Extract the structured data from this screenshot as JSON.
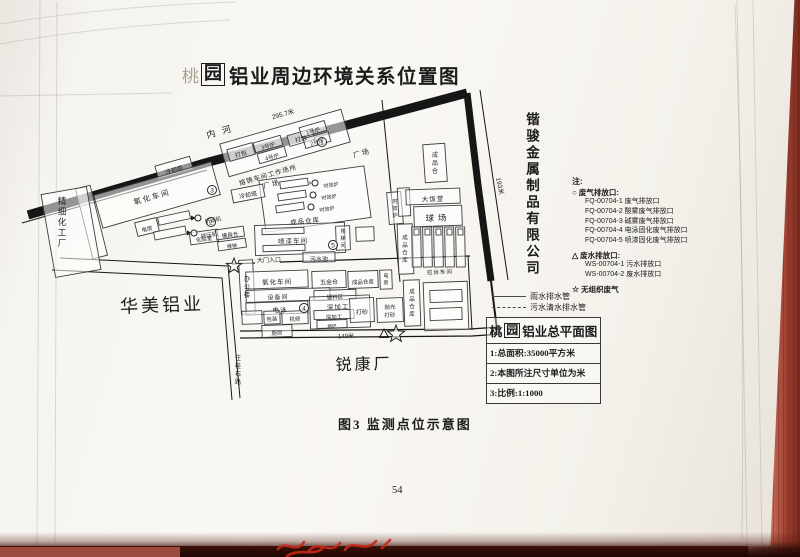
{
  "page": {
    "title": {
      "prefix": "桃",
      "boxed": "园",
      "rest": "铝业周边环境关系位置图"
    },
    "caption": "图3  监测点位示意图",
    "page_number": "54"
  },
  "neighbors": {
    "right_company": "锴骏金属制品有限公司",
    "left_company": "华美铝业",
    "left_factory": "精细化工厂",
    "bottom_factory": "锐康厂",
    "road_label": "往桂石路"
  },
  "legend": {
    "note_label": "注:",
    "gas": {
      "symbol": "○",
      "title": "废气排放口:",
      "items": [
        "FQ-00704-1 废气排放口",
        "FQ-00704-2 酸雾废气排放口",
        "FQ-00704-3 碱雾废气排放口",
        "FQ-00704-4 电泳固化废气排放口",
        "FQ-00704-5 喷漆固化废气排放口"
      ]
    },
    "water": {
      "symbol": "△",
      "title": "废水排放口:",
      "items": [
        "WS-00704-1 污水排放口",
        "WS-00704-2 废水排放口"
      ]
    },
    "fugitive": {
      "symbol": "☆",
      "title": "无组织废气"
    }
  },
  "pipes": [
    {
      "style": "solid",
      "label": "雨水排水管"
    },
    {
      "style": "dashed",
      "label": "污水清水排水管"
    }
  ],
  "info_box": {
    "title_prefix": "桃",
    "title_boxed": "园",
    "title_rest": "铝业总平面图",
    "rows": [
      "1:总面积:35000平方米",
      "2:本图所注尺寸单位为米",
      "3:比例:1:1000"
    ]
  },
  "map": {
    "river_label": "内河",
    "boxes": [
      {
        "x": 156,
        "y": 161,
        "w": 36,
        "h": 13,
        "r": -16
      },
      {
        "x": 222,
        "y": 126,
        "w": 126,
        "h": 34,
        "r": -16
      },
      {
        "x": 228,
        "y": 146,
        "w": 26,
        "h": 12,
        "r": -16
      },
      {
        "x": 254,
        "y": 139,
        "w": 28,
        "h": 10,
        "r": -16
      },
      {
        "x": 258,
        "y": 150,
        "w": 28,
        "h": 10,
        "r": -16
      },
      {
        "x": 288,
        "y": 132,
        "w": 26,
        "h": 11,
        "r": -16
      },
      {
        "x": 300,
        "y": 124,
        "w": 26,
        "h": 10,
        "r": -16
      },
      {
        "x": 304,
        "y": 135,
        "w": 26,
        "h": 10,
        "r": -16
      },
      {
        "x": 96,
        "y": 178,
        "w": 122,
        "h": 34,
        "r": -16
      },
      {
        "x": 84,
        "y": 186,
        "w": 15,
        "h": 72,
        "r": -14
      },
      {
        "x": 48,
        "y": 190,
        "w": 46,
        "h": 84,
        "r": -10
      },
      {
        "x": 136,
        "y": 220,
        "w": 22,
        "h": 14,
        "r": -14
      },
      {
        "x": 158,
        "y": 214,
        "w": 32,
        "h": 8,
        "r": -12
      },
      {
        "x": 154,
        "y": 229,
        "w": 32,
        "h": 8,
        "r": -11
      },
      {
        "x": 190,
        "y": 231,
        "w": 28,
        "h": 12,
        "r": -8
      },
      {
        "x": 216,
        "y": 228,
        "w": 28,
        "h": 10,
        "r": -8
      },
      {
        "x": 218,
        "y": 240,
        "w": 28,
        "h": 9,
        "r": -8
      },
      {
        "x": 240,
        "y": 260,
        "w": 14,
        "h": 54,
        "r": -3
      },
      {
        "x": 262,
        "y": 173,
        "w": 106,
        "h": 52,
        "r": -8
      },
      {
        "x": 280,
        "y": 180,
        "w": 28,
        "h": 7,
        "r": -8
      },
      {
        "x": 278,
        "y": 192,
        "w": 28,
        "h": 7,
        "r": -8
      },
      {
        "x": 276,
        "y": 204,
        "w": 28,
        "h": 7,
        "r": -8
      },
      {
        "x": 388,
        "y": 192,
        "w": 14,
        "h": 32,
        "r": -5
      },
      {
        "x": 232,
        "y": 187,
        "w": 32,
        "h": 13,
        "r": -11
      },
      {
        "x": 398,
        "y": 224,
        "w": 15,
        "h": 50,
        "r": -2
      },
      {
        "x": 424,
        "y": 144,
        "w": 22,
        "h": 38,
        "r": -4
      },
      {
        "x": 398,
        "y": 188,
        "w": 12,
        "h": 28,
        "r": -3
      },
      {
        "x": 406,
        "y": 189,
        "w": 54,
        "h": 15,
        "r": -2
      },
      {
        "x": 414,
        "y": 206,
        "w": 48,
        "h": 20,
        "r": -2
      },
      {
        "x": 255,
        "y": 224,
        "w": 90,
        "h": 30,
        "r": -2
      },
      {
        "x": 262,
        "y": 228,
        "w": 42,
        "h": 6,
        "r": -2
      },
      {
        "x": 263,
        "y": 245,
        "w": 42,
        "h": 6,
        "r": -2
      },
      {
        "x": 336,
        "y": 226,
        "w": 14,
        "h": 24,
        "r": -2
      },
      {
        "x": 356,
        "y": 227,
        "w": 18,
        "h": 14,
        "r": -2
      },
      {
        "x": 303,
        "y": 252,
        "w": 32,
        "h": 10,
        "r": -1
      },
      {
        "x": 246,
        "y": 271,
        "w": 62,
        "h": 17,
        "r": -2
      },
      {
        "x": 312,
        "y": 271,
        "w": 34,
        "h": 17,
        "r": -2
      },
      {
        "x": 348,
        "y": 271,
        "w": 30,
        "h": 17,
        "r": -2
      },
      {
        "x": 380,
        "y": 270,
        "w": 12,
        "h": 19,
        "r": -2
      },
      {
        "x": 246,
        "y": 289,
        "w": 84,
        "h": 12,
        "r": -2
      },
      {
        "x": 314,
        "y": 290,
        "w": 42,
        "h": 10,
        "r": -2
      },
      {
        "x": 246,
        "y": 302,
        "w": 62,
        "h": 12,
        "r": -2
      },
      {
        "x": 242,
        "y": 311,
        "w": 20,
        "h": 13,
        "r": -2
      },
      {
        "x": 264,
        "y": 311,
        "w": 16,
        "h": 13,
        "r": -2
      },
      {
        "x": 282,
        "y": 311,
        "w": 26,
        "h": 13,
        "r": -2
      },
      {
        "x": 262,
        "y": 325,
        "w": 30,
        "h": 12,
        "r": -2
      },
      {
        "x": 310,
        "y": 296,
        "w": 60,
        "h": 32,
        "r": -2
      },
      {
        "x": 314,
        "y": 310,
        "w": 40,
        "h": 9,
        "r": -2
      },
      {
        "x": 317,
        "y": 320,
        "w": 30,
        "h": 8,
        "r": -2
      },
      {
        "x": 350,
        "y": 298,
        "w": 24,
        "h": 24,
        "r": -2
      },
      {
        "x": 377,
        "y": 298,
        "w": 26,
        "h": 24,
        "r": -2
      },
      {
        "x": 404,
        "y": 280,
        "w": 16,
        "h": 46,
        "r": -2
      },
      {
        "x": 424,
        "y": 282,
        "w": 44,
        "h": 48,
        "r": -2
      },
      {
        "x": 430,
        "y": 290,
        "w": 32,
        "h": 12,
        "r": -2
      },
      {
        "x": 430,
        "y": 308,
        "w": 32,
        "h": 12,
        "r": -2
      },
      {
        "x": 412,
        "y": 227,
        "w": 9,
        "h": 40,
        "r": -1
      },
      {
        "x": 423,
        "y": 227,
        "w": 9,
        "h": 40,
        "r": -1
      },
      {
        "x": 434,
        "y": 227,
        "w": 9,
        "h": 40,
        "r": -1
      },
      {
        "x": 445,
        "y": 227,
        "w": 9,
        "h": 40,
        "r": -1
      },
      {
        "x": 456,
        "y": 227,
        "w": 9,
        "h": 40,
        "r": -1
      },
      {
        "x": 414,
        "y": 229,
        "w": 5,
        "h": 6,
        "r": -1
      },
      {
        "x": 425,
        "y": 229,
        "w": 5,
        "h": 6,
        "r": -1
      },
      {
        "x": 436,
        "y": 229,
        "w": 5,
        "h": 6,
        "r": -1
      },
      {
        "x": 447,
        "y": 229,
        "w": 5,
        "h": 6,
        "r": -1
      },
      {
        "x": 458,
        "y": 229,
        "w": 5,
        "h": 6,
        "r": -1
      }
    ],
    "labels": [
      {
        "t": "内河",
        "x": 222,
        "y": 131,
        "fs": 9,
        "r": -16,
        "ls": 7
      },
      {
        "t": "295.7米",
        "x": 283,
        "y": 114,
        "fs": 6.5,
        "r": -16
      },
      {
        "t": "193米",
        "x": 500,
        "y": 186,
        "fs": 6.5,
        "r": 78
      },
      {
        "t": "140米",
        "x": 346,
        "y": 336,
        "fs": 6,
        "r": -1
      },
      {
        "t": "冷却塔",
        "x": 174,
        "y": 170,
        "fs": 6,
        "r": -16
      },
      {
        "t": "打包",
        "x": 241,
        "y": 154,
        "fs": 6,
        "r": -16
      },
      {
        "t": "3号炉",
        "x": 268,
        "y": 146,
        "fs": 5.5,
        "r": -16
      },
      {
        "t": "4号炉",
        "x": 272,
        "y": 157,
        "fs": 5.5,
        "r": -16
      },
      {
        "t": "打包",
        "x": 301,
        "y": 139,
        "fs": 6,
        "r": -16
      },
      {
        "t": "1号炉",
        "x": 313,
        "y": 131,
        "fs": 5.5,
        "r": -16
      },
      {
        "t": "2号炉",
        "x": 317,
        "y": 142,
        "fs": 5.5,
        "r": -16
      },
      {
        "t": "熔铸车间工作场所",
        "x": 268,
        "y": 175,
        "fs": 6.5,
        "r": -16,
        "ls": 1
      },
      {
        "t": "厂场",
        "x": 362,
        "y": 153,
        "fs": 7,
        "r": -16,
        "ls": 2
      },
      {
        "t": "厂场",
        "x": 272,
        "y": 184,
        "fs": 7,
        "r": -14,
        "ls": 2
      },
      {
        "t": "氧化车间",
        "x": 152,
        "y": 197,
        "fs": 7.5,
        "r": -16,
        "ls": 2
      },
      {
        "t": "电房",
        "x": 147,
        "y": 229,
        "fs": 5.5,
        "r": -14
      },
      {
        "t": "挤压机",
        "x": 213,
        "y": 220,
        "fs": 5.5,
        "r": -10
      },
      {
        "t": "挤压机",
        "x": 209,
        "y": 235,
        "fs": 5.5,
        "r": -10
      },
      {
        "t": "化验室",
        "x": 204,
        "y": 239,
        "fs": 5.5,
        "r": -8
      },
      {
        "t": "模具仓",
        "x": 230,
        "y": 235,
        "fs": 5.5,
        "r": -8
      },
      {
        "t": "楼梯",
        "x": 232,
        "y": 246,
        "fs": 5,
        "r": -8
      },
      {
        "t": "办公楼",
        "x": 247,
        "y": 287,
        "fs": 6,
        "v": true
      },
      {
        "t": "精细化工厂",
        "x": 62,
        "y": 222,
        "fs": 8.5,
        "v": true
      },
      {
        "t": "华美铝业",
        "x": 162,
        "y": 305,
        "fs": 18,
        "r": -2,
        "ls": 3
      },
      {
        "t": "时效炉",
        "x": 331,
        "y": 185,
        "fs": 5,
        "r": -8
      },
      {
        "t": "时效炉",
        "x": 329,
        "y": 197,
        "fs": 5,
        "r": -8
      },
      {
        "t": "时效炉",
        "x": 327,
        "y": 209,
        "fs": 5,
        "r": -8
      },
      {
        "t": "成品仓库",
        "x": 305,
        "y": 221,
        "fs": 6.5,
        "r": -6,
        "ls": 1
      },
      {
        "t": "时效炉",
        "x": 395,
        "y": 208,
        "fs": 5,
        "v": true
      },
      {
        "t": "冷却塔",
        "x": 248,
        "y": 195,
        "fs": 6,
        "r": -11
      },
      {
        "t": "成品仓库",
        "x": 405,
        "y": 249,
        "fs": 5.5,
        "v": true
      },
      {
        "t": "成品仓",
        "x": 435,
        "y": 163,
        "fs": 6,
        "v": true
      },
      {
        "t": "大饭堂",
        "x": 433,
        "y": 199,
        "fs": 6.5,
        "r": -2,
        "ls": 1
      },
      {
        "t": "球场",
        "x": 438,
        "y": 218,
        "fs": 8.5,
        "r": -2,
        "ls": 4
      },
      {
        "t": "喷漆车间",
        "x": 293,
        "y": 241,
        "fs": 6.5,
        "r": -2,
        "ls": 1
      },
      {
        "t": "楼梯间",
        "x": 343,
        "y": 238,
        "fs": 5,
        "v": true
      },
      {
        "t": "大门入口",
        "x": 269,
        "y": 260,
        "fs": 6,
        "r": -1
      },
      {
        "t": "污水池",
        "x": 319,
        "y": 259,
        "fs": 6,
        "r": -1
      },
      {
        "t": "氧化车间",
        "x": 277,
        "y": 282,
        "fs": 6.5,
        "r": -2,
        "ls": 1
      },
      {
        "t": "设备间",
        "x": 278,
        "y": 297,
        "fs": 6,
        "r": -2,
        "ls": 1
      },
      {
        "t": "电泳",
        "x": 280,
        "y": 310,
        "fs": 6.5,
        "r": -2,
        "ls": 1
      },
      {
        "t": "包装",
        "x": 272,
        "y": 319,
        "fs": 5.5,
        "r": -2
      },
      {
        "t": "机修",
        "x": 295,
        "y": 319,
        "fs": 5.5,
        "r": -2
      },
      {
        "t": "厨房",
        "x": 277,
        "y": 333,
        "fs": 5.5,
        "r": -2
      },
      {
        "t": "深加工",
        "x": 338,
        "y": 307,
        "fs": 6.5,
        "r": -2,
        "ls": 1
      },
      {
        "t": "深加工",
        "x": 334,
        "y": 317,
        "fs": 5.5,
        "r": -2
      },
      {
        "t": "锅炉",
        "x": 332,
        "y": 326,
        "fs": 4.5,
        "r": -2
      },
      {
        "t": "打砂",
        "x": 362,
        "y": 312,
        "fs": 6,
        "r": -2
      },
      {
        "t": "抛光",
        "x": 390,
        "y": 307,
        "fs": 5.5,
        "r": -2
      },
      {
        "t": "打砂",
        "x": 390,
        "y": 315,
        "fs": 5.5,
        "r": -2
      },
      {
        "t": "五金仓",
        "x": 329,
        "y": 282,
        "fs": 6,
        "r": -2
      },
      {
        "t": "成品仓库",
        "x": 363,
        "y": 282,
        "fs": 5.5,
        "r": -2
      },
      {
        "t": "电房",
        "x": 386,
        "y": 279,
        "fs": 5,
        "v": true
      },
      {
        "t": "锯料区",
        "x": 335,
        "y": 297,
        "fs": 5.5,
        "r": -2
      },
      {
        "t": "成品仓库",
        "x": 412,
        "y": 303,
        "fs": 5.5,
        "v": true
      },
      {
        "t": "拉丝车间",
        "x": 440,
        "y": 272,
        "fs": 5.5,
        "r": -2,
        "ls": 1
      },
      {
        "t": "锐康厂",
        "x": 364,
        "y": 364,
        "fs": 16,
        "r": -1,
        "ls": 3
      },
      {
        "t": "往桂石路",
        "x": 238,
        "y": 370,
        "fs": 6,
        "v": true
      }
    ],
    "marks": [
      {
        "k": "c",
        "n": "1",
        "x": 322,
        "y": 142,
        "s": 4.5
      },
      {
        "k": "c",
        "n": "2",
        "x": 211,
        "y": 222,
        "s": 4.5
      },
      {
        "k": "c",
        "n": "3",
        "x": 212,
        "y": 190,
        "s": 4.5
      },
      {
        "k": "c",
        "n": "4",
        "x": 304,
        "y": 308,
        "s": 4.5
      },
      {
        "k": "c",
        "n": "5",
        "x": 333,
        "y": 245,
        "s": 4.5
      },
      {
        "k": "c",
        "n": "",
        "x": 198,
        "y": 218,
        "s": 3
      },
      {
        "k": "c",
        "n": "",
        "x": 194,
        "y": 233,
        "s": 3
      },
      {
        "k": "c",
        "n": "",
        "x": 315,
        "y": 183,
        "s": 3
      },
      {
        "k": "c",
        "n": "",
        "x": 313,
        "y": 195,
        "s": 3
      },
      {
        "k": "c",
        "n": "",
        "x": 311,
        "y": 207,
        "s": 3
      },
      {
        "k": "s",
        "n": "",
        "x": 234,
        "y": 266,
        "s": 8
      },
      {
        "k": "s",
        "n": "",
        "x": 396,
        "y": 334,
        "s": 9
      },
      {
        "k": "t",
        "n": "",
        "x": 384,
        "y": 334,
        "s": 5
      }
    ]
  }
}
